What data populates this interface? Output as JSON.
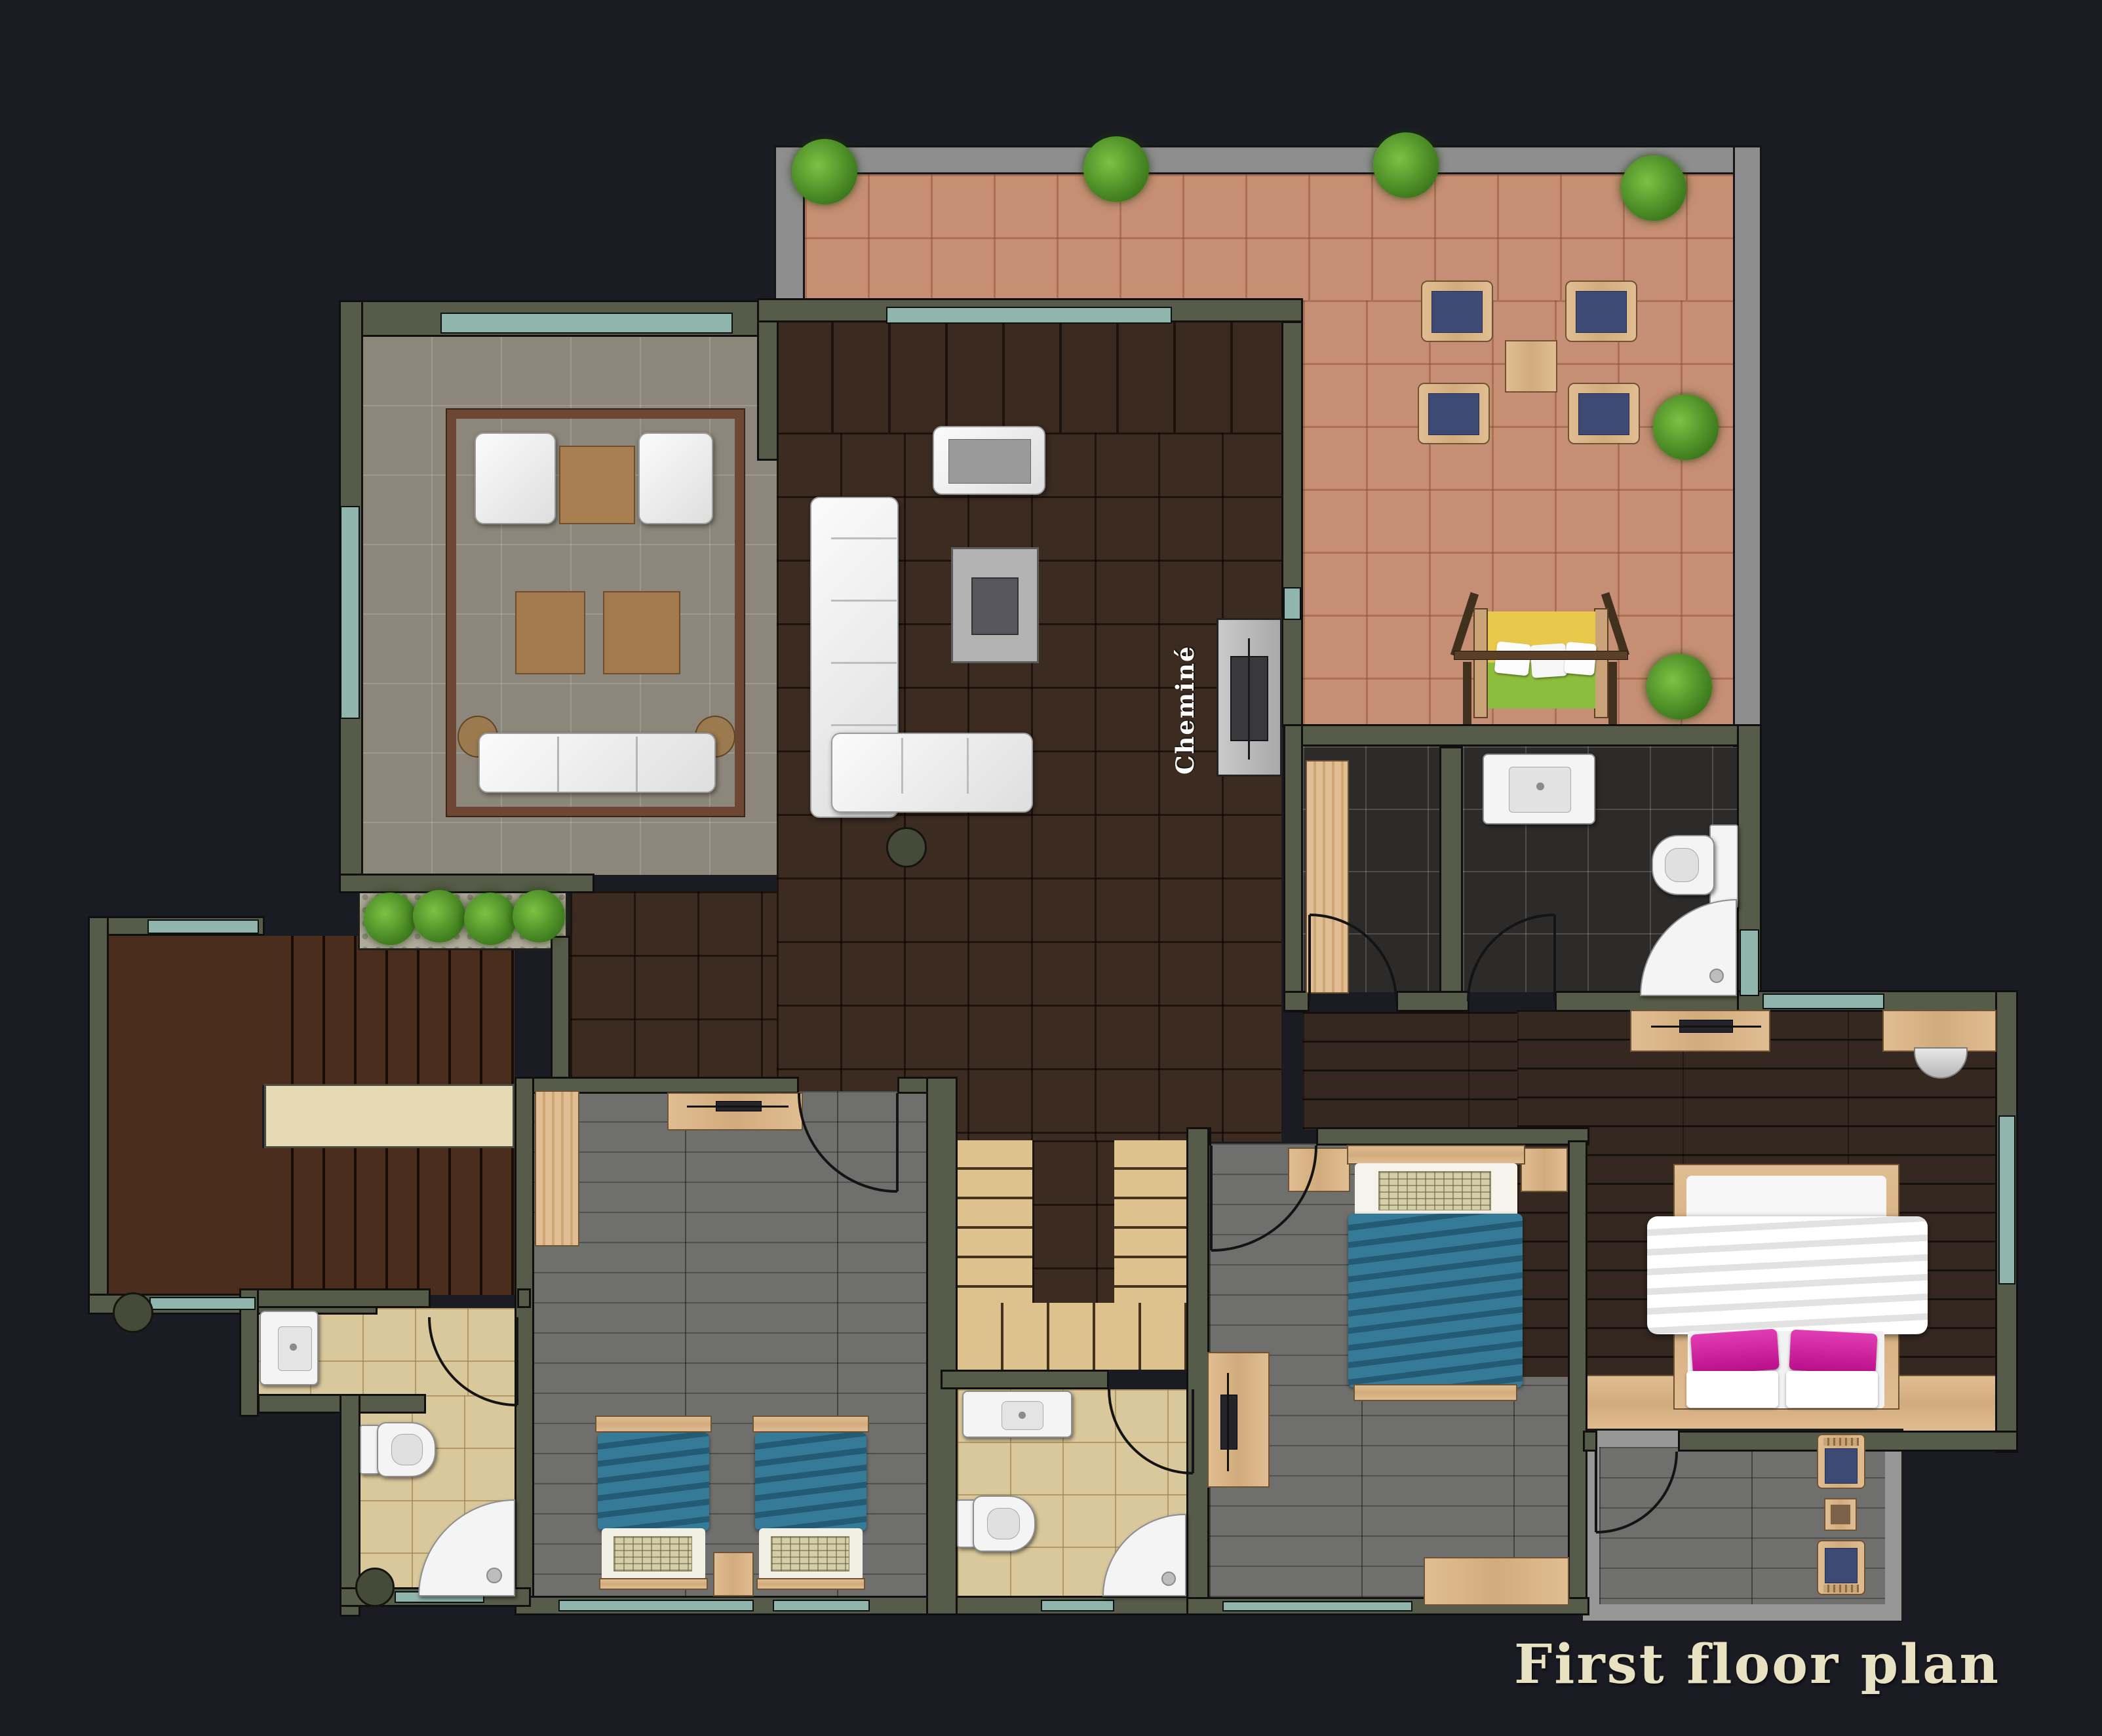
{
  "labels": {
    "title": "First floor plan",
    "fireplace": "Cheminé"
  },
  "palette": {
    "background": "#1b1b24",
    "wall": "#575b49",
    "window_glass": "#8fb5ad",
    "terrace_tile": "#c68e74",
    "living_tile": "#8d877b",
    "family_tile": "#3b2b21",
    "bedroom_plank": "#6f6f6d",
    "master_plank": "#352820",
    "stair_beige": "#ddc28e",
    "bathroom_tile": "#d9c89c",
    "dark_bathroom_tile": "#2d2b29",
    "wood_furniture": "#dcb98e",
    "teal_blanket": "#2e7291",
    "pink_pillow": "#cf1fa2",
    "blue_cushion": "#3c4a74",
    "plant_green": "#4e9e2f",
    "title_text": "#e9e2c2"
  },
  "plan": {
    "type": "residential first floor plan, top-down rendered view",
    "rooms": [
      {
        "name": "terrace",
        "floor": "terracotta tile",
        "furniture": [
          "outdoor dining table",
          "4 chairs with blue cushions",
          "swing bench with yellow-green cushion",
          "6 shrubs"
        ]
      },
      {
        "name": "living-room",
        "floor": "gray ceramic tile",
        "furniture": [
          "2 white armchairs",
          "coffee table",
          "2 side tables",
          "3-seat white sofa",
          "2 round end tables",
          "brown border rug"
        ]
      },
      {
        "name": "family-room",
        "floor": "dark brown tile",
        "furniture": [
          "white L-shaped sectional sofa",
          "white loveseat",
          "tv table",
          "round stool",
          "fireplace (Cheminé)"
        ]
      },
      {
        "name": "entry-porch-stairs",
        "floor": "dark wood",
        "furniture": [
          "exterior staircase with landing",
          "planter with 4 plants",
          "round planter"
        ]
      },
      {
        "name": "interior-staircase",
        "floor": "beige stone steps",
        "furniture": [
          "u-shaped stair flights"
        ]
      },
      {
        "name": "kids-bedroom",
        "floor": "gray plank",
        "furniture": [
          "2 single beds with teal blankets",
          "dresser with tv",
          "wardrobe",
          "nightstand"
        ]
      },
      {
        "name": "bedroom-2",
        "floor": "gray plank",
        "furniture": [
          "double bed with teal blanket",
          "2 nightstands",
          "desk with tv",
          "dresser"
        ]
      },
      {
        "name": "master-bedroom",
        "floor": "dark wood plank",
        "furniture": [
          "double bed with white duvet and pink pillows",
          "2 dressers",
          "tv",
          "半round chair",
          "bench band"
        ]
      },
      {
        "name": "dark-bathroom",
        "floor": "dark slate tile",
        "furniture": [
          "sink",
          "toilet",
          "corner shower"
        ]
      },
      {
        "name": "closet-room",
        "floor": "dark slate tile",
        "furniture": [
          "wardrobe"
        ]
      },
      {
        "name": "bathroom-1",
        "floor": "beige tile",
        "furniture": [
          "sink",
          "toilet",
          "corner shower",
          "round planter"
        ]
      },
      {
        "name": "bathroom-2",
        "floor": "beige tile",
        "furniture": [
          "vanity sink",
          "toilet",
          "corner shower"
        ]
      },
      {
        "name": "balcony",
        "floor": "gray plank",
        "furniture": [
          "2 wooden chairs with blue cushions",
          "small table"
        ]
      }
    ]
  }
}
